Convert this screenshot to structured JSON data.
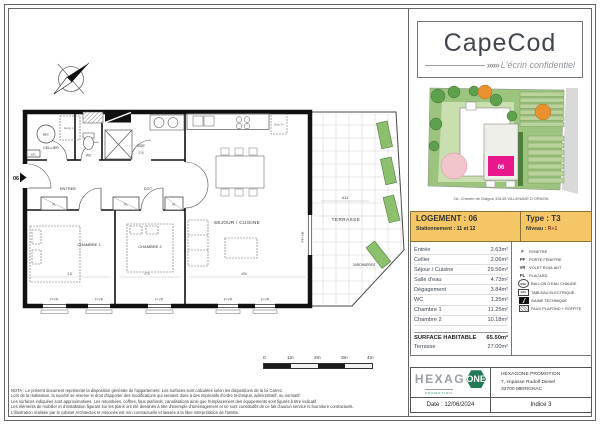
{
  "brand": {
    "name": "CapeCod",
    "chevrons": "»»»",
    "tagline": "L'écrin confidentiel"
  },
  "site_plan": {
    "caption": "2A, Chemin de Galgon 33140 VILLENAVE D'ORNON",
    "unit_label": "06"
  },
  "unit": {
    "logement_label": "LOGEMENT :",
    "logement_value": "06",
    "type_label": "Type :",
    "type_value": "T3",
    "stationnement_label": "Stationnement :",
    "stationnement_value": "11 et 12",
    "niveau_label": "Niveau :",
    "niveau_value": "R+1"
  },
  "areas": {
    "rows": [
      {
        "name": "Entrée",
        "value": "2.63m²"
      },
      {
        "name": "Cellier",
        "value": "2.06m²"
      },
      {
        "name": "Séjour / Cuisine",
        "value": "29.56m²"
      },
      {
        "name": "Salle d'eau",
        "value": "4.73m²"
      },
      {
        "name": "Dégagement",
        "value": "3.84m²"
      },
      {
        "name": "WC",
        "value": "1.25m²"
      },
      {
        "name": "Chambre 1",
        "value": "11.25m²"
      },
      {
        "name": "Chambre 2",
        "value": "10.18m²"
      }
    ],
    "total_label": "SURFACE HABITABLE",
    "total_value": "65.50m²",
    "terrace_label": "Terrasse",
    "terrace_value": "27.00m²"
  },
  "legend": {
    "items": [
      {
        "key": "F",
        "label": "FENETRE"
      },
      {
        "key": "PF",
        "label": "PORTE FENETRE"
      },
      {
        "key": "VR",
        "label": "VOLET ROULANT"
      },
      {
        "key": "PL",
        "label": "PLACARD"
      },
      {
        "key": "BEC",
        "label": "BALLON D'EAU CHAUDE"
      },
      {
        "key": "GTL",
        "label": "TABLEAU ELECTRIQUE"
      },
      {
        "key": "",
        "label": "GAINE TECHNIQUE"
      },
      {
        "key": "",
        "label": "FAUX PLAFOND + SOFFITE"
      }
    ]
  },
  "plan": {
    "entrance_marker": "06",
    "rooms": {
      "cellier": "CELLIER",
      "wc": "WC",
      "sde": "SDE",
      "entree": "ENTREE",
      "dgt": "DGT",
      "sejour": "SEJOUR / CUISINE",
      "chambre1": "CHAMBRE 1",
      "chambre2": "CHAMBRE 2",
      "terrasse": "TERRASSE"
    },
    "labels": {
      "bec": "BEC",
      "gtl": "GTL",
      "emp_ll": "Emp. LL",
      "emp_fr": "Emp. Fr",
      "pl": "PL",
      "f_vr": "F+VR",
      "pf_vr": "PF+VR",
      "jardinieres": "JARDINIERES"
    },
    "dims": {
      "sde": "215",
      "chambre1": "311",
      "chambre2": "270",
      "sejour": "455",
      "terrasse": "411"
    }
  },
  "scalebar": {
    "labels": [
      "0",
      "1m",
      "2m",
      "3m",
      "4m"
    ]
  },
  "notes": {
    "lines": [
      "NOTA : Le présent document représente la disposition générale de l'appartement. Les surfaces sont calculées selon les dispositions de la loi Carrez.",
      "Lors de la réalisation, la société se réserve le droit d'apporter des modifications qui seraient dues à des impératifs d'ordre technique, administratif, ou normatif.",
      "Les surfaces indiquées sont approximatives. Les retombées, coffres, faux plafonds, canalisations ainsi que l'emplacement des équipements sont figurés à titre indicatif.",
      "Les éléments de mobilier et d'installation figurant sur les plans ont été dessinés à titre d'exemple d'aménagement et ne sont constitutifs de ce fait d'aucun service ni fourniture contractuels.",
      "L'illustration réalisée par le cabinet Architectes et Associés est non contractuelle et laissée à la libre interprétation de l'artiste."
    ]
  },
  "footer": {
    "logo_text_1": "HEXAG",
    "logo_text_2": "ONE",
    "logo_sub": "PROMOTION",
    "company": "HEXAGONE PROMOTION",
    "address_1": "7, impasse Rudolf Diesel",
    "address_2": "33700 MERIGNAC",
    "date": "Date : 12/06/2024",
    "indice": "Indice 3"
  },
  "colors": {
    "header_bg": "#F4C666",
    "magenta": "#E8188C",
    "hexagone_green": "#217A55"
  }
}
